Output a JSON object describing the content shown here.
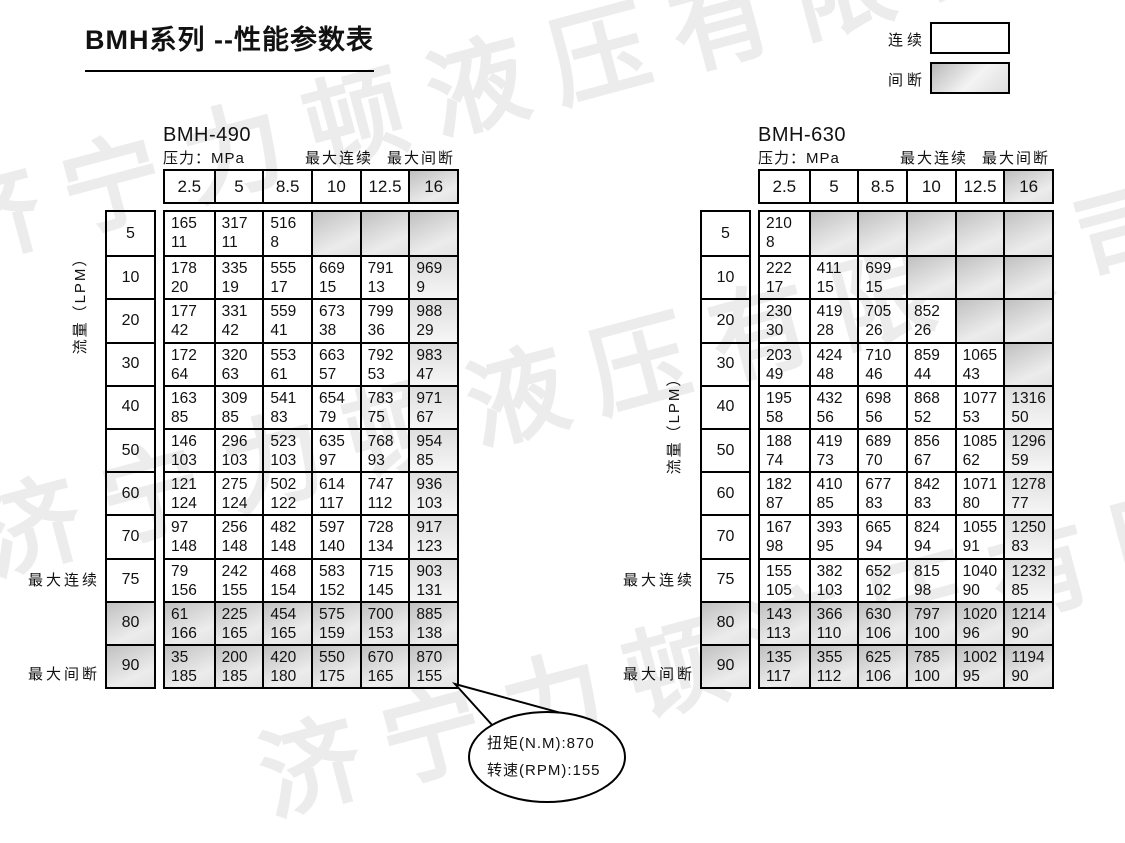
{
  "page": {
    "title": "BMH系列 --性能参数表"
  },
  "legend": {
    "continuous_label": "连续",
    "intermittent_label": "间断"
  },
  "labels": {
    "pressure": "压力：MPa",
    "max_continuous": "最大连续",
    "max_intermittent": "最大间断",
    "flow": "流量（LPM）"
  },
  "pressures": [
    "2.5",
    "5",
    "8.5",
    "10",
    "12.5",
    "16"
  ],
  "flows": [
    "5",
    "10",
    "20",
    "30",
    "40",
    "50",
    "60",
    "70",
    "75",
    "80",
    "90"
  ],
  "max_continuous_flow": "75",
  "max_intermittent_flow": "90",
  "tables": [
    {
      "name": "BMH-490",
      "rows": [
        [
          [
            "165",
            "11"
          ],
          [
            "317",
            "11"
          ],
          [
            "516",
            "8"
          ],
          null,
          null,
          null
        ],
        [
          [
            "178",
            "20"
          ],
          [
            "335",
            "19"
          ],
          [
            "555",
            "17"
          ],
          [
            "669",
            "15"
          ],
          [
            "791",
            "13"
          ],
          [
            "969",
            "9"
          ]
        ],
        [
          [
            "177",
            "42"
          ],
          [
            "331",
            "42"
          ],
          [
            "559",
            "41"
          ],
          [
            "673",
            "38"
          ],
          [
            "799",
            "36"
          ],
          [
            "988",
            "29"
          ]
        ],
        [
          [
            "172",
            "64"
          ],
          [
            "320",
            "63"
          ],
          [
            "553",
            "61"
          ],
          [
            "663",
            "57"
          ],
          [
            "792",
            "53"
          ],
          [
            "983",
            "47"
          ]
        ],
        [
          [
            "163",
            "85"
          ],
          [
            "309",
            "85"
          ],
          [
            "541",
            "83"
          ],
          [
            "654",
            "79"
          ],
          [
            "783",
            "75"
          ],
          [
            "971",
            "67"
          ]
        ],
        [
          [
            "146",
            "103"
          ],
          [
            "296",
            "103"
          ],
          [
            "523",
            "103"
          ],
          [
            "635",
            "97"
          ],
          [
            "768",
            "93"
          ],
          [
            "954",
            "85"
          ]
        ],
        [
          [
            "121",
            "124"
          ],
          [
            "275",
            "124"
          ],
          [
            "502",
            "122"
          ],
          [
            "614",
            "117"
          ],
          [
            "747",
            "112"
          ],
          [
            "936",
            "103"
          ]
        ],
        [
          [
            "97",
            "148"
          ],
          [
            "256",
            "148"
          ],
          [
            "482",
            "148"
          ],
          [
            "597",
            "140"
          ],
          [
            "728",
            "134"
          ],
          [
            "917",
            "123"
          ]
        ],
        [
          [
            "79",
            "156"
          ],
          [
            "242",
            "155"
          ],
          [
            "468",
            "154"
          ],
          [
            "583",
            "152"
          ],
          [
            "715",
            "145"
          ],
          [
            "903",
            "131"
          ]
        ],
        [
          [
            "61",
            "166"
          ],
          [
            "225",
            "165"
          ],
          [
            "454",
            "165"
          ],
          [
            "575",
            "159"
          ],
          [
            "700",
            "153"
          ],
          [
            "885",
            "138"
          ]
        ],
        [
          [
            "35",
            "185"
          ],
          [
            "200",
            "185"
          ],
          [
            "420",
            "180"
          ],
          [
            "550",
            "175"
          ],
          [
            "670",
            "165"
          ],
          [
            "870",
            "155"
          ]
        ]
      ]
    },
    {
      "name": "BMH-630",
      "rows": [
        [
          [
            "210",
            "8"
          ],
          null,
          null,
          null,
          null,
          null
        ],
        [
          [
            "222",
            "17"
          ],
          [
            "411",
            "15"
          ],
          [
            "699",
            "15"
          ],
          null,
          null,
          null
        ],
        [
          [
            "230",
            "30"
          ],
          [
            "419",
            "28"
          ],
          [
            "705",
            "26"
          ],
          [
            "852",
            "26"
          ],
          null,
          null
        ],
        [
          [
            "203",
            "49"
          ],
          [
            "424",
            "48"
          ],
          [
            "710",
            "46"
          ],
          [
            "859",
            "44"
          ],
          [
            "1065",
            "43"
          ],
          null
        ],
        [
          [
            "195",
            "58"
          ],
          [
            "432",
            "56"
          ],
          [
            "698",
            "56"
          ],
          [
            "868",
            "52"
          ],
          [
            "1077",
            "53"
          ],
          [
            "1316",
            "50"
          ]
        ],
        [
          [
            "188",
            "74"
          ],
          [
            "419",
            "73"
          ],
          [
            "689",
            "70"
          ],
          [
            "856",
            "67"
          ],
          [
            "1085",
            "62"
          ],
          [
            "1296",
            "59"
          ]
        ],
        [
          [
            "182",
            "87"
          ],
          [
            "410",
            "85"
          ],
          [
            "677",
            "83"
          ],
          [
            "842",
            "83"
          ],
          [
            "1071",
            "80"
          ],
          [
            "1278",
            "77"
          ]
        ],
        [
          [
            "167",
            "98"
          ],
          [
            "393",
            "95"
          ],
          [
            "665",
            "94"
          ],
          [
            "824",
            "94"
          ],
          [
            "1055",
            "91"
          ],
          [
            "1250",
            "83"
          ]
        ],
        [
          [
            "155",
            "105"
          ],
          [
            "382",
            "103"
          ],
          [
            "652",
            "102"
          ],
          [
            "815",
            "98"
          ],
          [
            "1040",
            "90"
          ],
          [
            "1232",
            "85"
          ]
        ],
        [
          [
            "143",
            "113"
          ],
          [
            "366",
            "110"
          ],
          [
            "630",
            "106"
          ],
          [
            "797",
            "100"
          ],
          [
            "1020",
            "96"
          ],
          [
            "1214",
            "90"
          ]
        ],
        [
          [
            "135",
            "117"
          ],
          [
            "355",
            "112"
          ],
          [
            "625",
            "106"
          ],
          [
            "785",
            "100"
          ],
          [
            "1002",
            "95"
          ],
          [
            "1194",
            "90"
          ]
        ]
      ]
    }
  ],
  "callout": {
    "torque": "扭矩(N.M):870",
    "speed": "转速(RPM):155"
  },
  "watermark": {
    "text": "济宁力顿液压有限公司"
  }
}
